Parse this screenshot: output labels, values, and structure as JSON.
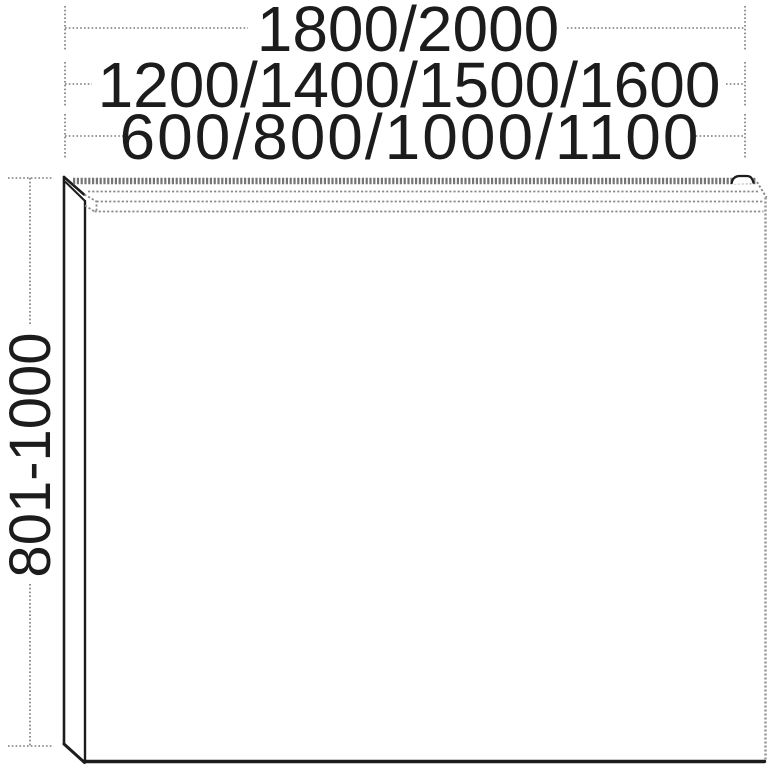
{
  "drawing": {
    "width_dimensions_mm": {
      "row_top": "1800/2000",
      "row_middle": "1200/1400/1500/1600",
      "row_bottom": "600/800/1000/1100"
    },
    "height_dimension_mm": "801-1000",
    "colors": {
      "line_black": "#1c1c1c",
      "line_gray": "#8a8a8a",
      "dimension_gray": "#787878",
      "background": "#ffffff"
    }
  }
}
